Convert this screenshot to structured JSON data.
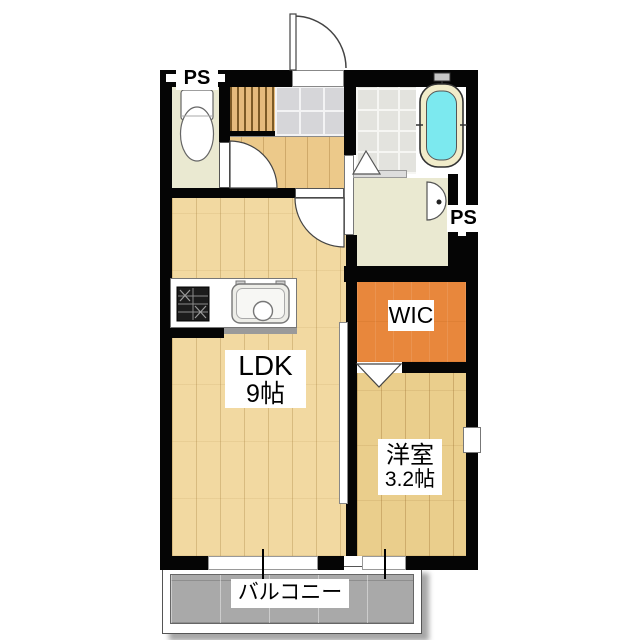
{
  "plan_title": "1LDK apartment floor plan",
  "labels": {
    "ps_top_left": "PS",
    "ps_right": "PS",
    "wic": "WIC",
    "ldk_name": "LDK",
    "ldk_size": "9帖",
    "western_room_name": "洋室",
    "western_room_size": "3.2帖",
    "balcony": "バルコニー"
  },
  "colors": {
    "wall": "#050505",
    "wood_light": "#f2d9a1",
    "wood_dark": "#eace8c",
    "hall_wood": "#ecc98a",
    "wic_orange": "#e8873c",
    "bath_water": "#7ce9ef",
    "tub_rim": "#f1ecca",
    "pale_floor": "#eae9d1",
    "genkan_tile": "#d6d6d9",
    "balcony_gray": "#a9a9a9",
    "label_text": "#000000"
  }
}
